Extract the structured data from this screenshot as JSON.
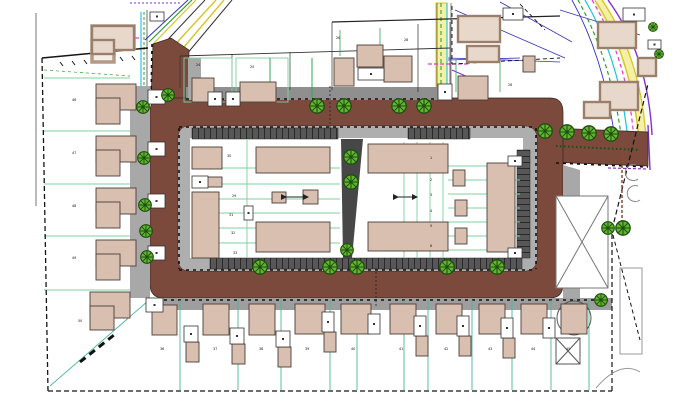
{
  "drawing": {
    "title": "residential-site-plan",
    "type": "site layout plan"
  },
  "colors": {
    "road": "#7b4a3d",
    "road_edge": "#33241d",
    "sidewalk": "#a8a8a8",
    "sidewalk_dark": "#8f8f8f",
    "island_walk": "#aeaeae",
    "stall": "#575757",
    "stall_line": "#151515",
    "path_strip": "#474747",
    "building_new": "#d9bfb0",
    "building_new_outline": "#4a3f38",
    "building_exist_fill": "#e8d8cc",
    "building_exist_outline": "#9b7f6a",
    "tree_fill": "#62b52e",
    "tree_dark": "#1d4d10",
    "plot_green": "#7ed0a0",
    "plot_green_dark": "#2fa84f",
    "teal": "#49b89a",
    "boundary": "#141414",
    "yellow": "#d8c426",
    "yellow_pale": "#f5f0a8",
    "cyan": "#19c3d8",
    "magenta": "#dd3ccc",
    "purple": "#8330d0",
    "blue": "#3333bb",
    "green_util": "#2ca32c",
    "gray_line": "#8a8a8a",
    "brown_dash": "#8a4a2e"
  },
  "trees": [
    [
      168,
      95,
      7
    ],
    [
      143,
      107,
      7
    ],
    [
      144,
      158,
      7
    ],
    [
      145,
      205,
      7
    ],
    [
      146,
      231,
      7
    ],
    [
      147,
      257,
      7
    ],
    [
      317,
      106,
      8
    ],
    [
      344,
      106,
      8
    ],
    [
      399,
      106,
      8
    ],
    [
      424,
      106,
      8
    ],
    [
      260,
      267,
      8
    ],
    [
      330,
      267,
      8
    ],
    [
      357,
      267,
      8
    ],
    [
      447,
      267,
      8
    ],
    [
      497,
      267,
      8
    ],
    [
      351,
      157,
      8
    ],
    [
      351,
      182,
      8
    ],
    [
      347,
      250,
      7
    ],
    [
      545,
      131,
      8
    ],
    [
      567,
      132,
      8
    ],
    [
      589,
      133,
      8
    ],
    [
      611,
      134,
      8
    ],
    [
      608,
      228,
      7
    ],
    [
      623,
      228,
      8
    ],
    [
      601,
      300,
      7
    ],
    [
      653,
      27,
      5
    ],
    [
      659,
      54,
      5
    ]
  ],
  "buildings_new": [
    [
      192,
      147,
      30,
      22
    ],
    [
      205,
      177,
      17,
      10
    ],
    [
      192,
      192,
      27,
      66
    ],
    [
      256,
      147,
      74,
      26
    ],
    [
      256,
      222,
      74,
      30
    ],
    [
      272,
      192,
      14,
      11
    ],
    [
      303,
      190,
      15,
      14
    ],
    [
      368,
      144,
      80,
      29
    ],
    [
      368,
      222,
      80,
      29
    ],
    [
      487,
      163,
      28,
      89
    ],
    [
      453,
      170,
      12,
      16
    ],
    [
      455,
      200,
      12,
      16
    ],
    [
      455,
      228,
      12,
      16
    ],
    [
      96,
      84,
      40,
      26
    ],
    [
      96,
      98,
      24,
      26
    ],
    [
      96,
      136,
      40,
      26
    ],
    [
      96,
      150,
      24,
      26
    ],
    [
      96,
      188,
      40,
      26
    ],
    [
      96,
      202,
      24,
      26
    ],
    [
      96,
      240,
      40,
      26
    ],
    [
      96,
      254,
      24,
      26
    ],
    [
      90,
      292,
      40,
      26
    ],
    [
      90,
      306,
      24,
      24
    ],
    [
      192,
      78,
      22,
      24
    ],
    [
      240,
      82,
      36,
      20
    ],
    [
      334,
      58,
      20,
      28
    ],
    [
      357,
      45,
      26,
      22
    ],
    [
      384,
      56,
      28,
      26
    ],
    [
      458,
      76,
      30,
      24
    ],
    [
      523,
      56,
      12,
      16
    ],
    [
      152,
      305,
      25,
      30
    ],
    [
      203,
      304,
      26,
      31
    ],
    [
      249,
      304,
      26,
      31
    ],
    [
      295,
      304,
      30,
      30
    ],
    [
      341,
      304,
      30,
      30
    ],
    [
      390,
      304,
      26,
      30
    ],
    [
      436,
      304,
      26,
      30
    ],
    [
      479,
      304,
      26,
      30
    ],
    [
      521,
      304,
      26,
      30
    ],
    [
      561,
      304,
      26,
      30
    ],
    [
      186,
      342,
      13,
      20
    ],
    [
      232,
      344,
      13,
      20
    ],
    [
      278,
      347,
      13,
      20
    ],
    [
      324,
      332,
      12,
      20
    ],
    [
      416,
      336,
      12,
      20
    ],
    [
      459,
      336,
      12,
      20
    ],
    [
      503,
      338,
      12,
      20
    ]
  ],
  "buildings_existing": [
    [
      92,
      26,
      42,
      24
    ],
    [
      92,
      40,
      22,
      14
    ],
    [
      458,
      16,
      42,
      26
    ],
    [
      467,
      46,
      32,
      16
    ],
    [
      598,
      22,
      38,
      26
    ],
    [
      600,
      82,
      38,
      28
    ],
    [
      638,
      58,
      18,
      18
    ],
    [
      584,
      102,
      26,
      16
    ]
  ],
  "white_sheds": [
    [
      150,
      12,
      14,
      9
    ],
    [
      503,
      8,
      20,
      12
    ],
    [
      623,
      8,
      22,
      13
    ],
    [
      648,
      40,
      13,
      9
    ],
    [
      148,
      90,
      17,
      14
    ],
    [
      148,
      142,
      17,
      14
    ],
    [
      148,
      194,
      17,
      14
    ],
    [
      148,
      246,
      17,
      14
    ],
    [
      146,
      298,
      17,
      14
    ],
    [
      208,
      92,
      14,
      14
    ],
    [
      226,
      92,
      14,
      14
    ],
    [
      358,
      68,
      26,
      12
    ],
    [
      438,
      84,
      14,
      16
    ],
    [
      184,
      326,
      14,
      16
    ],
    [
      230,
      328,
      14,
      16
    ],
    [
      276,
      331,
      14,
      16
    ],
    [
      322,
      312,
      12,
      20
    ],
    [
      368,
      314,
      12,
      20
    ],
    [
      414,
      316,
      12,
      20
    ],
    [
      457,
      316,
      12,
      20
    ],
    [
      501,
      318,
      12,
      20
    ],
    [
      543,
      318,
      12,
      20
    ],
    [
      244,
      206,
      9,
      14
    ],
    [
      192,
      176,
      16,
      12
    ],
    [
      508,
      156,
      14,
      10
    ],
    [
      508,
      248,
      14,
      10
    ]
  ],
  "labels": [
    {
      "x": 72,
      "y": 101,
      "t": "46"
    },
    {
      "x": 72,
      "y": 154,
      "t": "47"
    },
    {
      "x": 72,
      "y": 207,
      "t": "48"
    },
    {
      "x": 72,
      "y": 259,
      "t": "49"
    },
    {
      "x": 78,
      "y": 322,
      "t": "50"
    },
    {
      "x": 336,
      "y": 39,
      "t": "28"
    },
    {
      "x": 404,
      "y": 41,
      "t": "28"
    },
    {
      "x": 508,
      "y": 86,
      "t": "26"
    },
    {
      "x": 196,
      "y": 66,
      "t": "24"
    },
    {
      "x": 250,
      "y": 68,
      "t": "25"
    },
    {
      "x": 227,
      "y": 157,
      "t": "30"
    },
    {
      "x": 232,
      "y": 197,
      "t": "29"
    },
    {
      "x": 229,
      "y": 216,
      "t": "31"
    },
    {
      "x": 231,
      "y": 234,
      "t": "32"
    },
    {
      "x": 233,
      "y": 254,
      "t": "33"
    },
    {
      "x": 430,
      "y": 159,
      "t": "1"
    },
    {
      "x": 430,
      "y": 181,
      "t": "2"
    },
    {
      "x": 430,
      "y": 196,
      "t": "3"
    },
    {
      "x": 430,
      "y": 212,
      "t": "4"
    },
    {
      "x": 430,
      "y": 227,
      "t": "5"
    },
    {
      "x": 430,
      "y": 247,
      "t": "6"
    },
    {
      "x": 160,
      "y": 350,
      "t": "36"
    },
    {
      "x": 213,
      "y": 350,
      "t": "37"
    },
    {
      "x": 259,
      "y": 350,
      "t": "38"
    },
    {
      "x": 305,
      "y": 350,
      "t": "39"
    },
    {
      "x": 351,
      "y": 350,
      "t": "40"
    },
    {
      "x": 399,
      "y": 350,
      "t": "41"
    },
    {
      "x": 444,
      "y": 350,
      "t": "42"
    },
    {
      "x": 488,
      "y": 350,
      "t": "43"
    },
    {
      "x": 531,
      "y": 350,
      "t": "44"
    },
    {
      "x": 566,
      "y": 350,
      "t": "45"
    }
  ]
}
